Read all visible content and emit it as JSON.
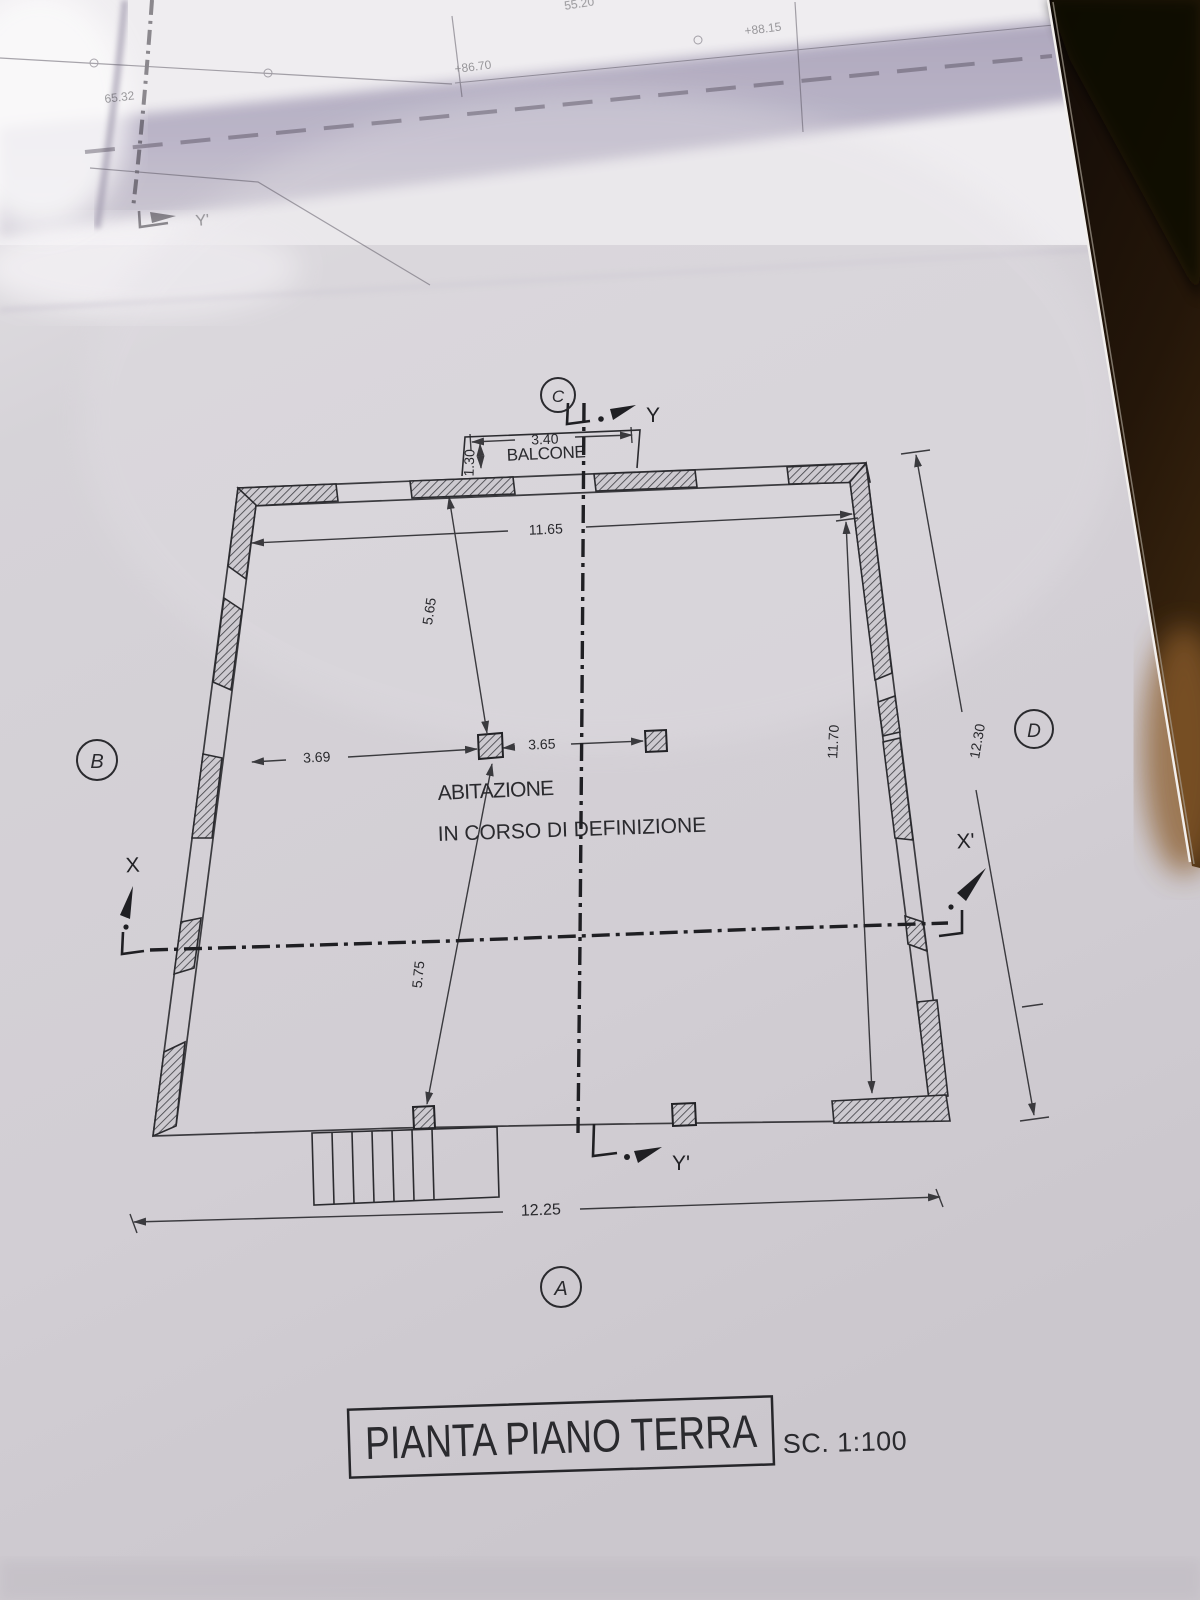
{
  "drawing": {
    "title": "PIANTA PIANO TERRA",
    "scale": "SC. 1:100",
    "room": {
      "line1": "ABITAZIONE",
      "line2": "IN CORSO DI DEFINIZIONE"
    },
    "balcony": {
      "label": "BALCONE",
      "width": "3.40",
      "depth": "1.30"
    },
    "dimensions": {
      "top_inner_width": "11.65",
      "upper_bay_depth": "5.65",
      "left_bay_width": "3.69",
      "center_bay_width": "3.65",
      "lower_bay_depth": "5.75",
      "right_inner_depth": "11.70",
      "right_overall_depth": "12.30",
      "bottom_overall_width": "12.25"
    },
    "grid_markers": {
      "top": "C",
      "left": "B",
      "right": "D",
      "bottom": "A"
    },
    "sections": {
      "y_start": "Y",
      "y_end": "Y'",
      "x_start": "X",
      "x_end": "X'"
    },
    "upper_sheet": {
      "section_end": "Y'",
      "spot_values": [
        "55.20",
        "65.32",
        "+86.70",
        "+88.15"
      ]
    },
    "colors": {
      "paper": "#d5d2d7",
      "ink": "#2a2a2e",
      "fold_shadow": "#b6b0c3",
      "background_dark": "#1d130c",
      "table_glow": "#8a5c2a"
    }
  }
}
